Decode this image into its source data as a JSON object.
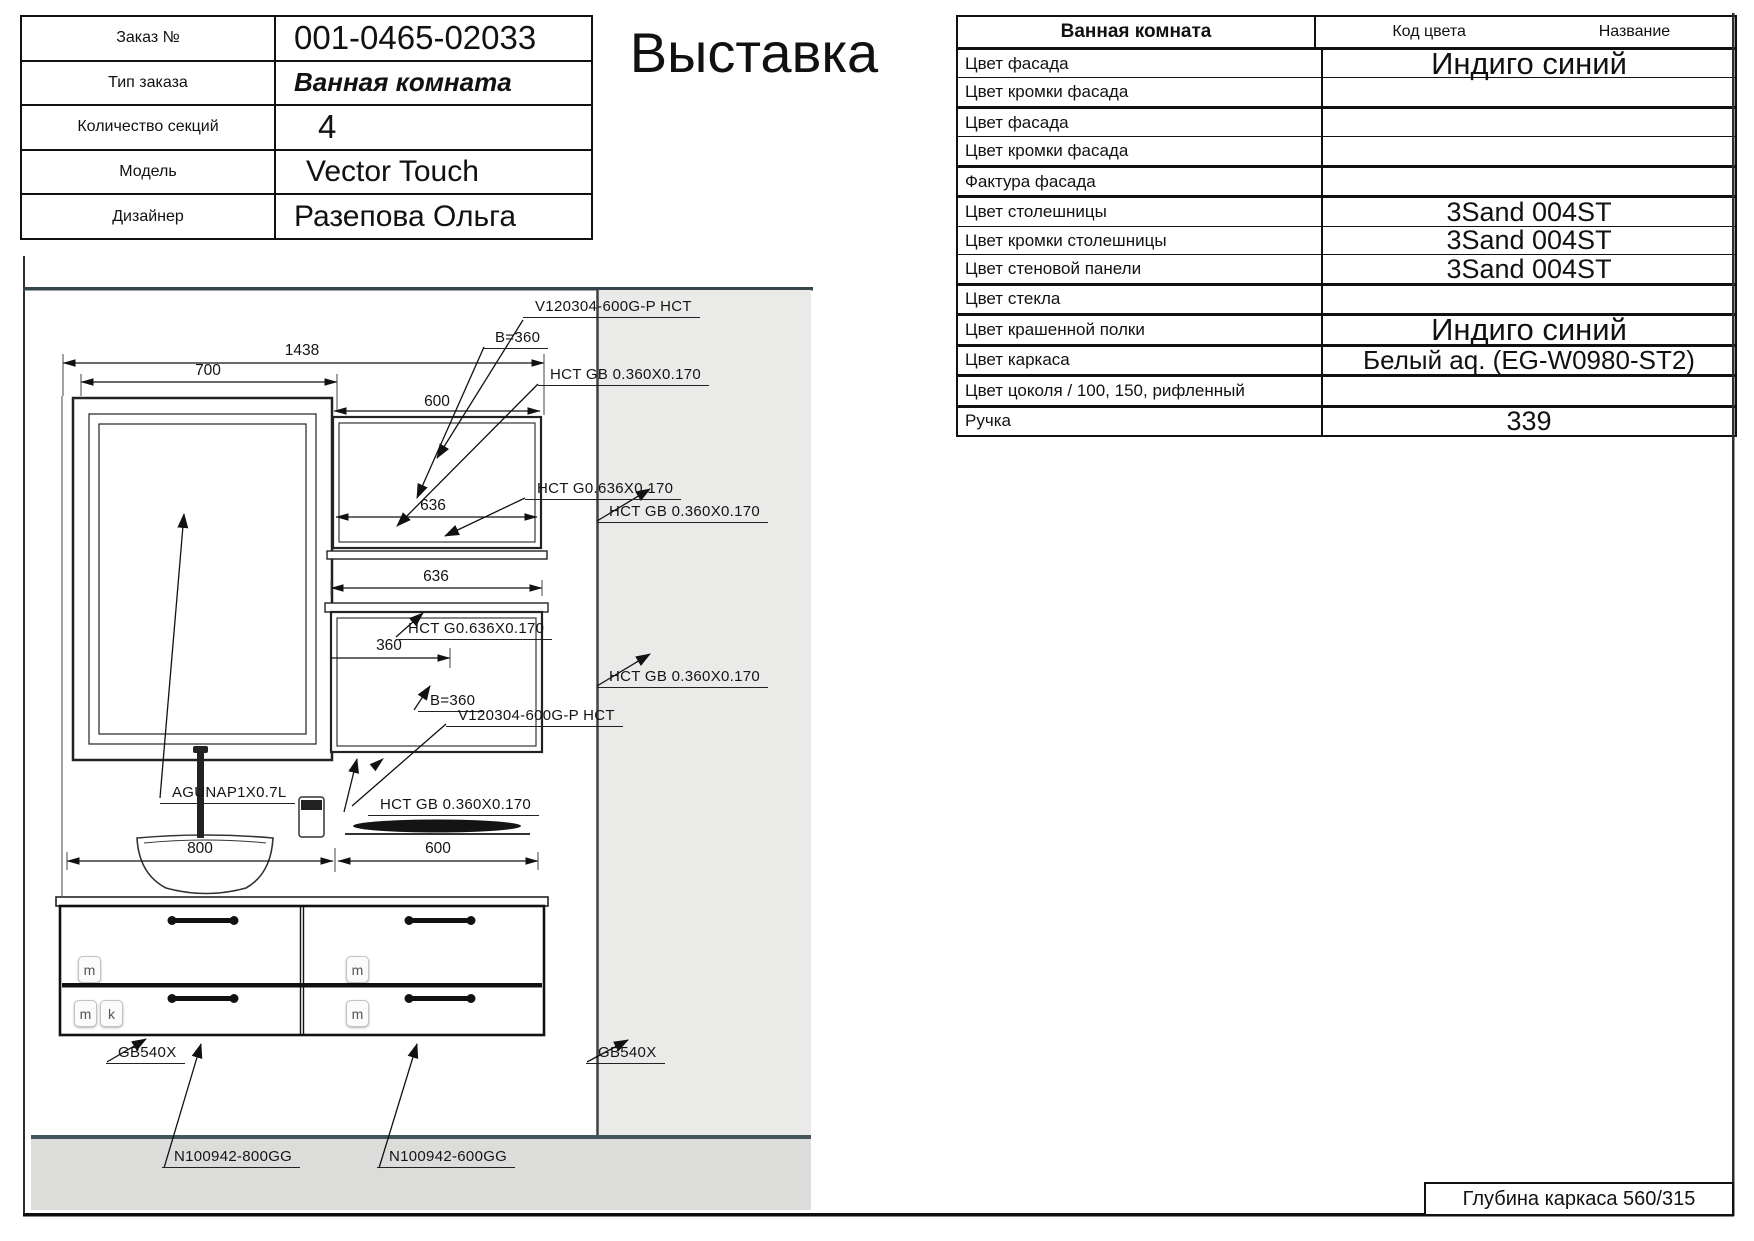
{
  "order_info": {
    "rows": [
      {
        "label": "Заказ №",
        "value": "001-0465-02033"
      },
      {
        "label": "Тип заказа",
        "value": "Ванная комната"
      },
      {
        "label": "Количество секций",
        "value": "4"
      },
      {
        "label": "Модель",
        "value": "Vector Touch"
      },
      {
        "label": "Дизайнер",
        "value": "Разепова Ольга"
      }
    ]
  },
  "title": "Выставка",
  "spec_table": {
    "header": {
      "title": "Ванная комната",
      "col_code": "Код цвета",
      "col_name": "Название"
    },
    "rows": [
      {
        "label": "Цвет фасада",
        "value": "Индиго синий"
      },
      {
        "label": "Цвет кромки фасада",
        "value": ""
      },
      {
        "label": "Цвет фасада",
        "value": ""
      },
      {
        "label": "Цвет кромки фасада",
        "value": ""
      },
      {
        "label": "Фактура фасада",
        "value": ""
      },
      {
        "label": "Цвет столешницы",
        "value": "3Sand 004ST"
      },
      {
        "label": "Цвет кромки столешницы",
        "value": "3Sand 004ST"
      },
      {
        "label": "Цвет стеновой панели",
        "value": "3Sand 004ST"
      },
      {
        "label": "Цвет стекла",
        "value": ""
      },
      {
        "label": "Цвет крашенной полки",
        "value": "Индиго синий"
      },
      {
        "label": "Цвет каркаса",
        "value": "Белый aq. (EG-W0980-ST2)"
      },
      {
        "label": "Цвет цоколя / 100, 150, рифленный",
        "value": ""
      },
      {
        "label": "Ручка",
        "value": "339"
      }
    ]
  },
  "footer": {
    "depth_note": "Глубина каркаса 560/315"
  },
  "drawing": {
    "dims": {
      "total": "1438",
      "mirror": "700",
      "upper_cabinet": "600",
      "shelf_upper": "636",
      "shelf_mid": "636",
      "inner_360": "360",
      "vanity_left": "800",
      "vanity_right": "600"
    },
    "labels": {
      "v120304_top": "V120304-600G-P HCT",
      "b360_top": "B=360",
      "hct_gb_top": "HCT GB 0.360X0.170",
      "hct_g636_top": "HCT G0.636X0.170",
      "hct_gb_wall_upper": "HCT GB 0.360X0.170",
      "hct_g636_lower": "HCT G0.636X0.170",
      "b360_lower": "B=360",
      "v120304_lower": "V120304-600G-P HCT",
      "hct_gb_sink": "HCT GB 0.360X0.170",
      "hct_gb_wall_lower": "HCT GB 0.360X0.170",
      "faucet_code": "AGUNAP1X0.7L",
      "gb540x_left": "GB540X",
      "gb540x_right": "GB540X",
      "n100942_800": "N100942-800GG",
      "n100942_600": "N100942-600GG"
    },
    "badges": {
      "m": "m",
      "k": "k"
    },
    "colors": {
      "wall_band": "#eaeae9",
      "floor_band": "#dcdcdb",
      "line": "#111111"
    }
  }
}
